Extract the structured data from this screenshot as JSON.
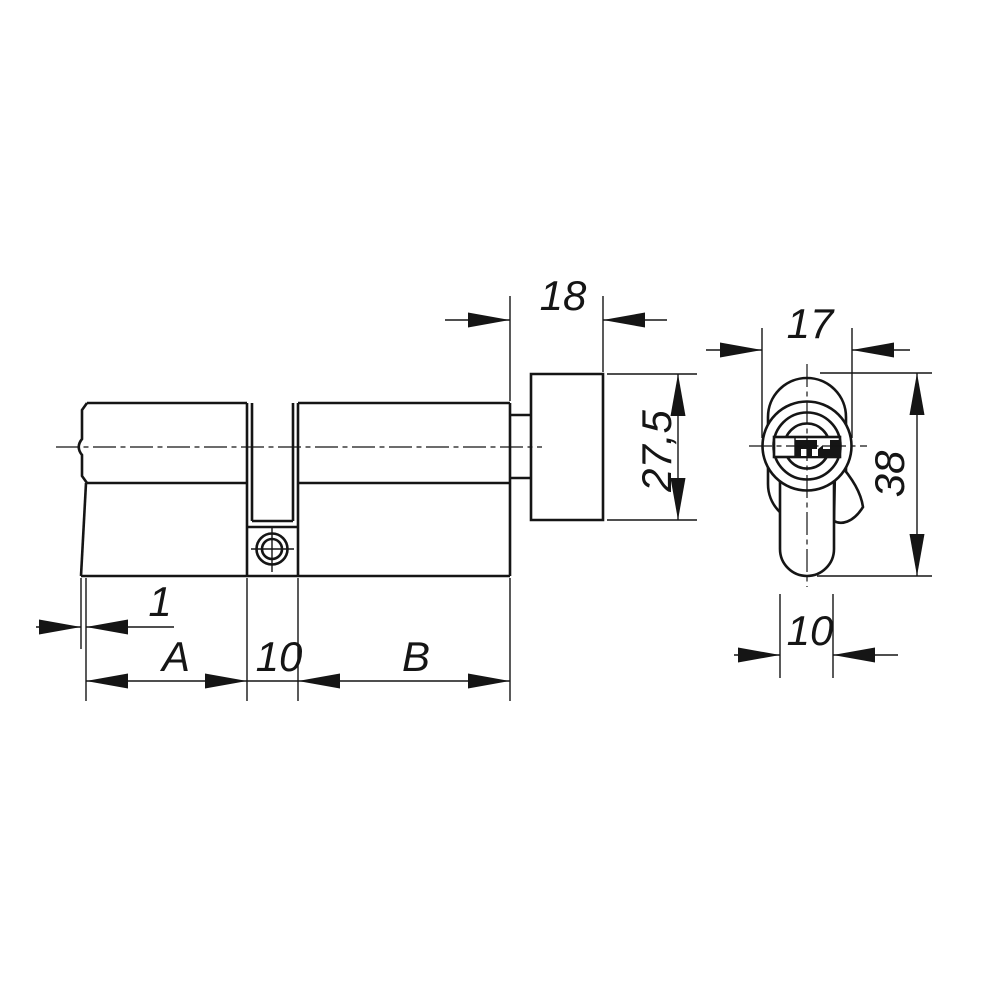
{
  "drawing": {
    "type": "technical-drawing",
    "subject": "euro profile lock cylinder with thumbturn, two orthographic views",
    "background_color": "#ffffff",
    "line_color": "#151515",
    "side_view": {
      "name": "cylinder side view",
      "dims": {
        "knob_length": {
          "label": "18",
          "meaning": "thumbturn knob length"
        },
        "knob_diameter": {
          "label": "27,5",
          "meaning": "thumbturn knob height"
        },
        "face_offset": {
          "label": "1",
          "meaning": "front face offset"
        },
        "length_a": {
          "label": "A",
          "meaning": "outside half length"
        },
        "cam_width": {
          "label": "10",
          "meaning": "cam slot width"
        },
        "length_b": {
          "label": "B",
          "meaning": "inside half length"
        }
      }
    },
    "front_view": {
      "name": "cylinder front view",
      "dims": {
        "body_diameter": {
          "label": "17",
          "meaning": "cylinder barrel diameter"
        },
        "total_height": {
          "label": "38",
          "meaning": "overall profile height"
        },
        "stem_width": {
          "label": "10",
          "meaning": "profile stem width"
        }
      }
    }
  }
}
